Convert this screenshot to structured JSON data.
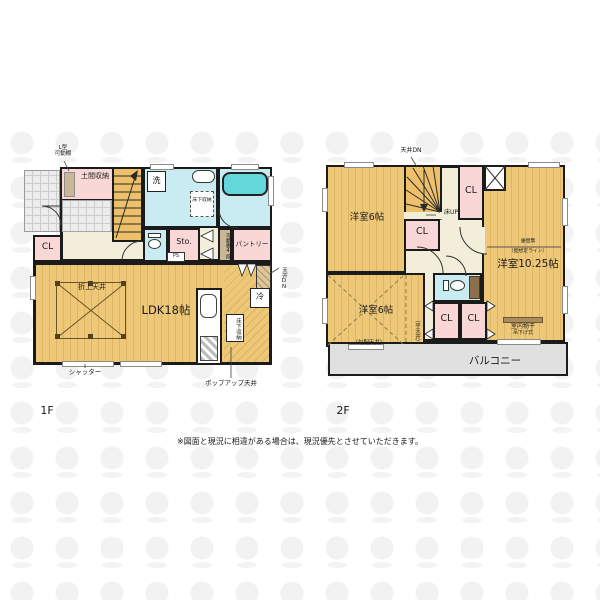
{
  "floor1": {
    "label": "1F",
    "l_shelf_line1": "L型",
    "l_shelf_line2": "可動棚",
    "doma": "土間収納",
    "washer": "洗",
    "underfloor_small": "床下収納",
    "cl": "CL",
    "sto": "Sto.",
    "ps": "PS",
    "shelf4": "可動棚4段",
    "pantry": "パントリー",
    "ceiling_dn": "天井DN",
    "oriage": "折上天井",
    "ldk": "LDK18帖",
    "underfloor_kitchen": "床下収納",
    "fridge": "冷",
    "shutter": "シャッター",
    "popup_ceiling": "ポップアップ天井"
  },
  "floor2": {
    "label": "2F",
    "ceiling_dn": "天井DN",
    "room6_top": "洋室6帖",
    "cl": "CL",
    "floor_up": "床UP",
    "tarekabe": "垂壁無",
    "wall_line": "（壁想定ライン）",
    "room1025": "洋室10.25帖",
    "room6_bottom": "洋室6帖",
    "slope_ceiling": "（勾配天井）",
    "flat_ceiling": "（平天井）",
    "monohoshi_line1": "室内物干",
    "monohoshi_line2": "吊下げ式",
    "balcony": "バルコニー"
  },
  "footer": {
    "disclaimer": "※図面と現況に相違がある場合は、現況優先とさせていただきます。"
  },
  "colors": {
    "wood": "#edc878",
    "pink": "#f9d7d6",
    "cyan": "#c9ecf2",
    "tub": "#62d8da",
    "beige": "#f3eeda",
    "balcony_gray": "#e0e0e0",
    "wall": "#1b1b1b"
  }
}
